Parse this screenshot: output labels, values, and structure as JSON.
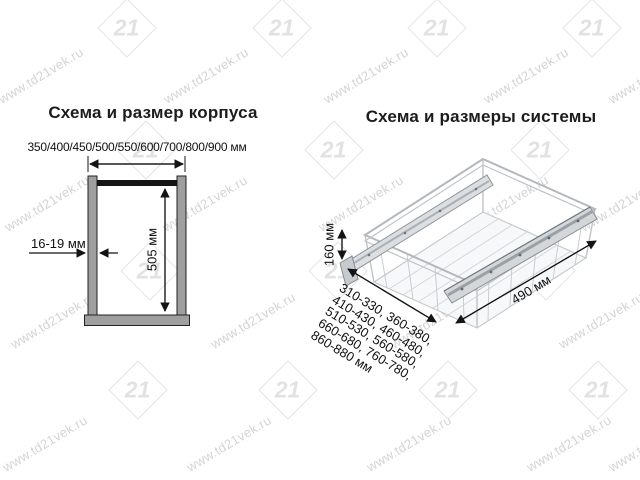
{
  "watermark": {
    "url_text": "www.td21vek.ru",
    "logo_text": "21",
    "color": "#d4d4d4"
  },
  "left_panel": {
    "title": "Схема и размер корпуса",
    "width_options_label": "350/400/450/500/550/600/700/800/900 мм",
    "thickness_label": "16-19 мм",
    "height_label": "505 мм"
  },
  "right_panel": {
    "title": "Схема и размеры системы",
    "height_label": "160 мм",
    "depth_label": "490 мм",
    "width_ranges": [
      "310-330, 360-380,",
      "410-430, 460-480,",
      "510-530, 560-580,",
      "660-680, 760-780,",
      "860-880 мм"
    ]
  },
  "colors": {
    "line": "#141414",
    "panel_gray": "#9f9f9f",
    "top_bar": "#141414",
    "basket_wire": "#c2c6ca",
    "slide_gray": "#d3d7da",
    "watermark_gray": "#d4d4d4"
  }
}
